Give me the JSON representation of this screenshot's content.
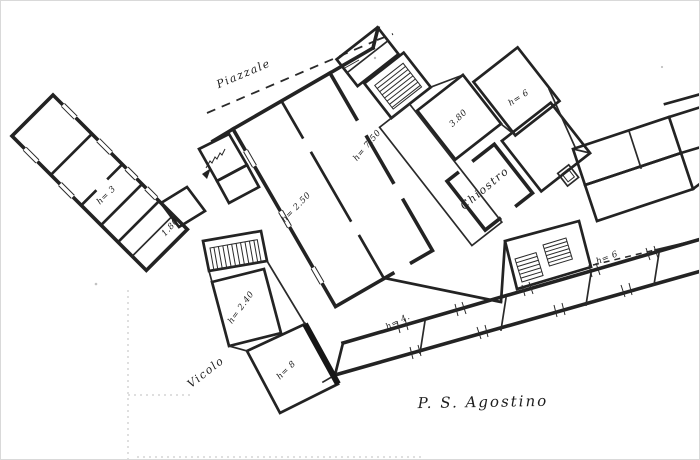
{
  "plan": {
    "title": "P. S. Agostino",
    "labels": {
      "piazzale": "Piazzale",
      "vicolo": "Vicolo",
      "chiostro": "Chiostro",
      "room_h750": "h= 7.50",
      "room_h250": "h= 2.50",
      "room_380": "3.80",
      "room_h6_top": "h= 6",
      "room_h6_east": "h= 6",
      "room_h3": "h= 3",
      "room_180": "1.80",
      "room_h240": "h= 2.40",
      "room_h8": "h= 8",
      "room_h4": "h= 4."
    }
  }
}
